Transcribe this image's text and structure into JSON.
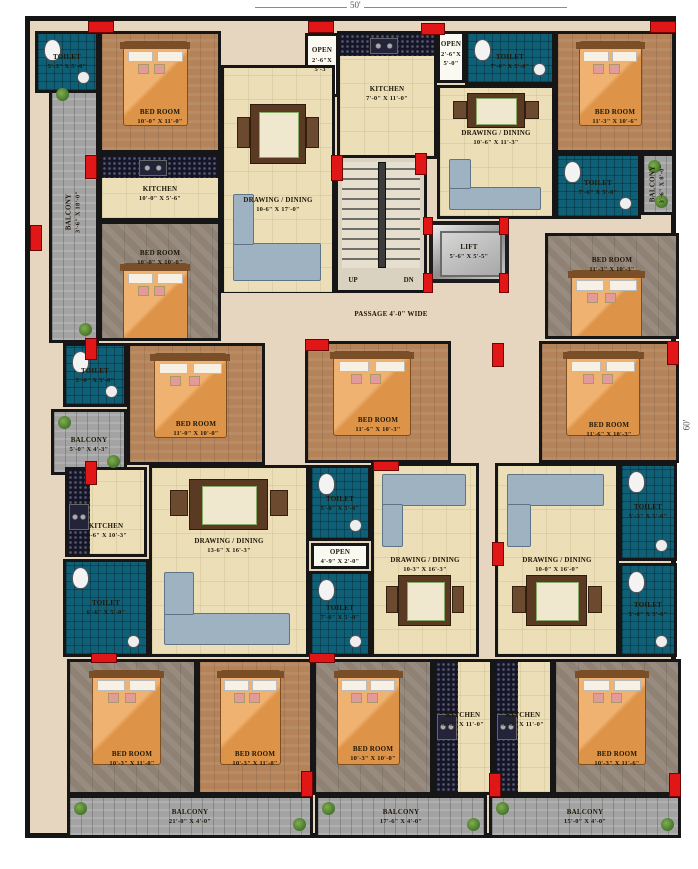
{
  "dimensions": {
    "width_label": "50'",
    "height_label": "60'"
  },
  "core": {
    "stair_up": "UP",
    "stair_down": "DN",
    "passage_label": "PASSAGE 4'-0\" WIDE"
  },
  "colors": {
    "wall": "#161616",
    "toilet_tile": "#0f6077",
    "wood_floor": "#b5835a",
    "grey_floor": "#8f8275",
    "marble_cream": "#ecdfb8",
    "balcony_stone": "#a3a3a3",
    "kitchen_counter": "#15152a",
    "column_red": "#e11717",
    "bed_orange": "#eaa55e",
    "sofa_grey": "#9fb2c2"
  },
  "rooms": [
    {
      "id": "balc-L",
      "name": "BALCONY",
      "dims": "3'-6\" X 18'-0\""
    },
    {
      "id": "wc-TL",
      "name": "TOILET",
      "dims": "5'-3\" X 5'-0\""
    },
    {
      "id": "bed-TL",
      "name": "BED ROOM",
      "dims": "10'-0\" X 11'-0\""
    },
    {
      "id": "open-TL",
      "name": "OPEN",
      "dims": "2'-6\"X 5'-3\""
    },
    {
      "id": "kit-L",
      "name": "KITCHEN",
      "dims": "10'-0\" X 5'-6\""
    },
    {
      "id": "dd-L",
      "name": "DRAWING / DINING",
      "dims": "10-6\" X 17'-0\""
    },
    {
      "id": "bed-L2",
      "name": "BED ROOM",
      "dims": "10'-0\" X 10'-0\""
    },
    {
      "id": "wc-L2",
      "name": "TOILET",
      "dims": "5'-0\" X 5'-0\""
    },
    {
      "id": "balc-L2",
      "name": "BALCONY",
      "dims": "5'-0\" X 4'-3\""
    },
    {
      "id": "bed-L3",
      "name": "BED ROOM",
      "dims": "11'-0\" X 10'-0\""
    },
    {
      "id": "kit-BL",
      "name": "KITCHEN",
      "dims": "6'-6\" X 10'-3\""
    },
    {
      "id": "wc-BL",
      "name": "TOILET",
      "dims": "6'-6\" X 5'-0\""
    },
    {
      "id": "dd-BL",
      "name": "DRAWING / DINING",
      "dims": "13-6\" X 16'-3\""
    },
    {
      "id": "kit-T",
      "name": "KITCHEN",
      "dims": "7'-0\" X 11'-0\""
    },
    {
      "id": "open-T",
      "name": "OPEN",
      "dims": "2'-6\"X 5'-0\""
    },
    {
      "id": "wc-T",
      "name": "TOILET",
      "dims": "7'-6\" X 5'-0\""
    },
    {
      "id": "dd-T",
      "name": "DRAWING / DINING",
      "dims": "10'-6\" X 11'-3\""
    },
    {
      "id": "bed-TR",
      "name": "BED ROOM",
      "dims": "11'-3\" X 10'-6\""
    },
    {
      "id": "wc-TR",
      "name": "TOILET",
      "dims": "7'-6\" X 5'-0\""
    },
    {
      "id": "balc-TR",
      "name": "BALCONY",
      "dims": "3'-6\" X 8'-0\""
    },
    {
      "id": "stair",
      "name": "",
      "dims": ""
    },
    {
      "id": "lift",
      "name": "LIFT",
      "dims": "5'-6\" X 5'-5\""
    },
    {
      "id": "passage",
      "name": "PASSAGE 4'-0\" WIDE",
      "dims": ""
    },
    {
      "id": "bed-C",
      "name": "BED ROOM",
      "dims": "11'-6\" X 10'-3\""
    },
    {
      "id": "wc-C1",
      "name": "TOILET",
      "dims": "5'-0\" X 5'-6\""
    },
    {
      "id": "open-C",
      "name": "OPEN",
      "dims": "4'-9\" X 2'-0\""
    },
    {
      "id": "wc-C2",
      "name": "TOILET",
      "dims": "7'-6\" X 5'-0\""
    },
    {
      "id": "dd-C",
      "name": "DRAWING / DINING",
      "dims": "10-3\" X 16'-3\""
    },
    {
      "id": "dd-R",
      "name": "DRAWING / DINING",
      "dims": "10-0\" X 16'-0\""
    },
    {
      "id": "wc-R1",
      "name": "TOILET",
      "dims": "5'-3\" X 5'-0\""
    },
    {
      "id": "wc-R2",
      "name": "TOILET",
      "dims": "5'-0\" X 5'-6\""
    },
    {
      "id": "bed-R2",
      "name": "BED ROOM",
      "dims": "11'-3\" X 10'-3\""
    },
    {
      "id": "bed-R3",
      "name": "BED ROOM",
      "dims": "11'-6\" X 10'-3\""
    },
    {
      "id": "bed-B1",
      "name": "BED ROOM",
      "dims": "10'-3\" X 11'-0\""
    },
    {
      "id": "bed-B2",
      "name": "BED ROOM",
      "dims": "10'-3\" X 11'-0\""
    },
    {
      "id": "bed-B3",
      "name": "BED ROOM",
      "dims": "10'-3\" X 10'-0\""
    },
    {
      "id": "kit-B1",
      "name": "KITCHEN",
      "dims": "5'-3\" X 11'-0\""
    },
    {
      "id": "kit-B2",
      "name": "KITCHEN",
      "dims": "5'-3\" X 11'-0\""
    },
    {
      "id": "bed-B4",
      "name": "BED ROOM",
      "dims": "10'-3\" X 11'-6\""
    },
    {
      "id": "balc-B1",
      "name": "BALCONY",
      "dims": "21'-0\" X 4'-0\""
    },
    {
      "id": "balc-B2",
      "name": "BALCONY",
      "dims": "17'-6\" X 4'-0\""
    },
    {
      "id": "balc-B3",
      "name": "BALCONY",
      "dims": "15'-0\" X 4'-0\""
    }
  ]
}
